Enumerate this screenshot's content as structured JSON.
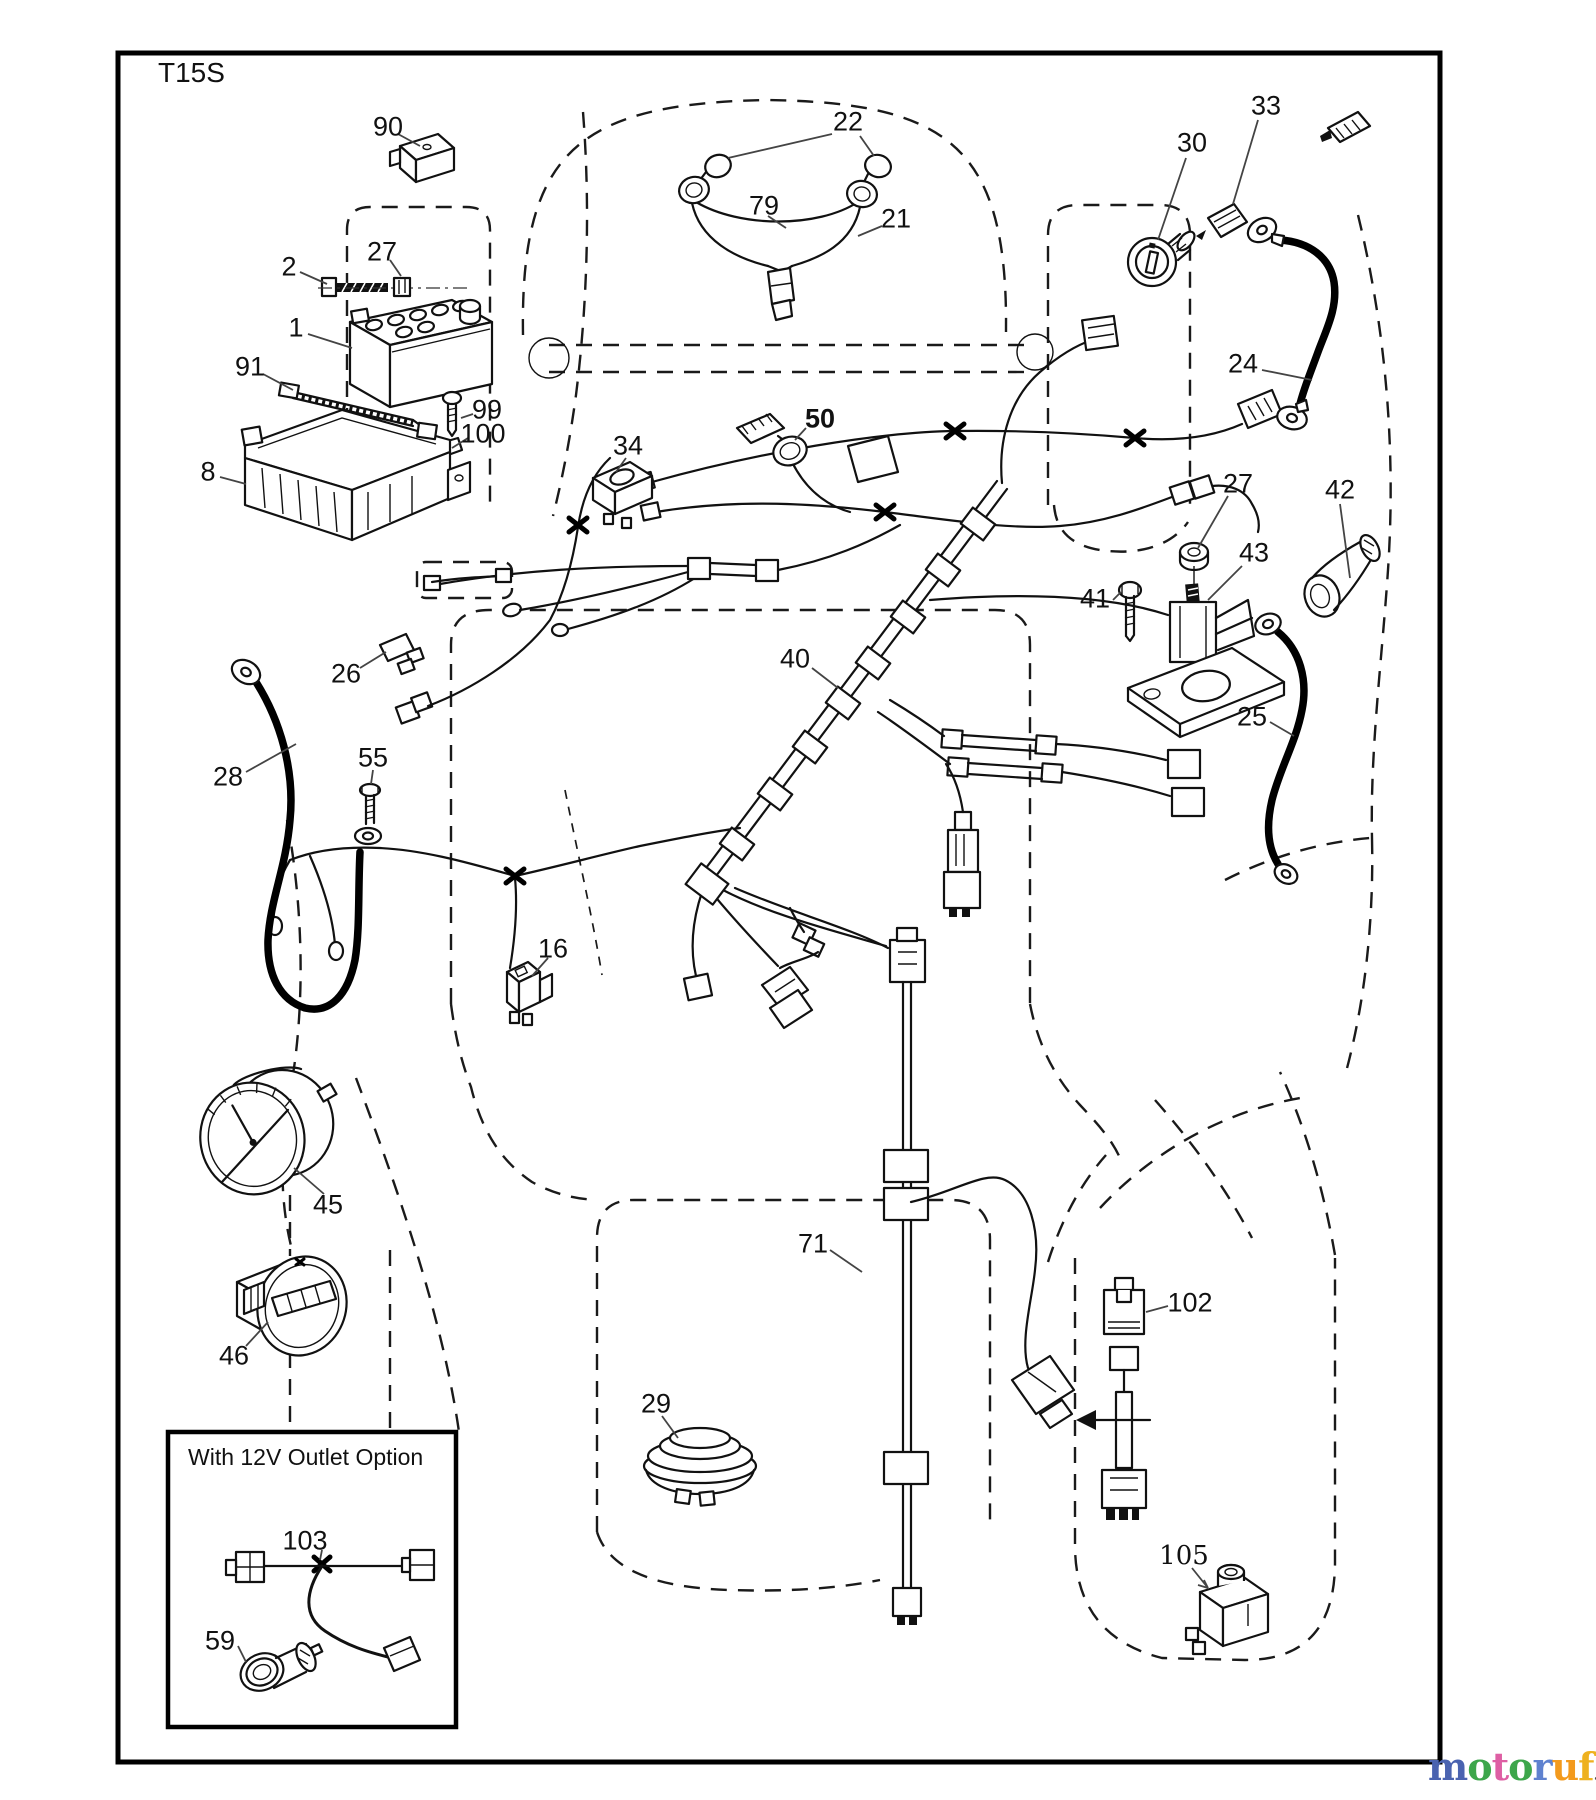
{
  "diagram": {
    "code": "T15S",
    "option_box": {
      "title": "With 12V Outlet Option"
    },
    "callouts": [
      {
        "id": "90",
        "x": 388,
        "y": 127
      },
      {
        "id": "2",
        "x": 289,
        "y": 267
      },
      {
        "id": "27",
        "x": 382,
        "y": 252
      },
      {
        "id": "1",
        "x": 296,
        "y": 328
      },
      {
        "id": "91",
        "x": 250,
        "y": 367
      },
      {
        "id": "99",
        "x": 487,
        "y": 410
      },
      {
        "id": "100",
        "x": 483,
        "y": 434
      },
      {
        "id": "8",
        "x": 208,
        "y": 472
      },
      {
        "id": "22",
        "x": 848,
        "y": 122
      },
      {
        "id": "79",
        "x": 764,
        "y": 206
      },
      {
        "id": "21",
        "x": 896,
        "y": 219
      },
      {
        "id": "30",
        "x": 1192,
        "y": 143
      },
      {
        "id": "33",
        "x": 1266,
        "y": 106
      },
      {
        "id": "24",
        "x": 1243,
        "y": 364
      },
      {
        "id": "34",
        "x": 628,
        "y": 446
      },
      {
        "id": "50",
        "x": 820,
        "y": 419,
        "bold": true
      },
      {
        "id": "26",
        "x": 346,
        "y": 674
      },
      {
        "id": "27",
        "x": 1238,
        "y": 484
      },
      {
        "id": "43",
        "x": 1254,
        "y": 553
      },
      {
        "id": "41",
        "x": 1095,
        "y": 599
      },
      {
        "id": "42",
        "x": 1340,
        "y": 490
      },
      {
        "id": "25",
        "x": 1252,
        "y": 717
      },
      {
        "id": "40",
        "x": 795,
        "y": 659
      },
      {
        "id": "28",
        "x": 228,
        "y": 777
      },
      {
        "id": "55",
        "x": 373,
        "y": 758
      },
      {
        "id": "16",
        "x": 553,
        "y": 949
      },
      {
        "id": "45",
        "x": 328,
        "y": 1205
      },
      {
        "id": "46",
        "x": 234,
        "y": 1356
      },
      {
        "id": "29",
        "x": 656,
        "y": 1404
      },
      {
        "id": "71",
        "x": 813,
        "y": 1244
      },
      {
        "id": "102",
        "x": 1190,
        "y": 1303
      },
      {
        "id": "103",
        "x": 305,
        "y": 1541
      },
      {
        "id": "59",
        "x": 220,
        "y": 1641
      },
      {
        "id": "105",
        "x": 1184,
        "y": 1556,
        "serif": true
      }
    ]
  },
  "branding": {
    "logo_word": "motoruf",
    "logo_suffix": ".de",
    "letters": [
      {
        "ch": "m",
        "color": "#4a63b0"
      },
      {
        "ch": "o",
        "color": "#3da64b"
      },
      {
        "ch": "t",
        "color": "#de5fa4"
      },
      {
        "ch": "o",
        "color": "#3da64b"
      },
      {
        "ch": "r",
        "color": "#5f82cf"
      },
      {
        "ch": "u",
        "color": "#f39a1d"
      },
      {
        "ch": "f",
        "color": "#eeb11f"
      }
    ],
    "suffix_color": "#4a4a4a"
  }
}
